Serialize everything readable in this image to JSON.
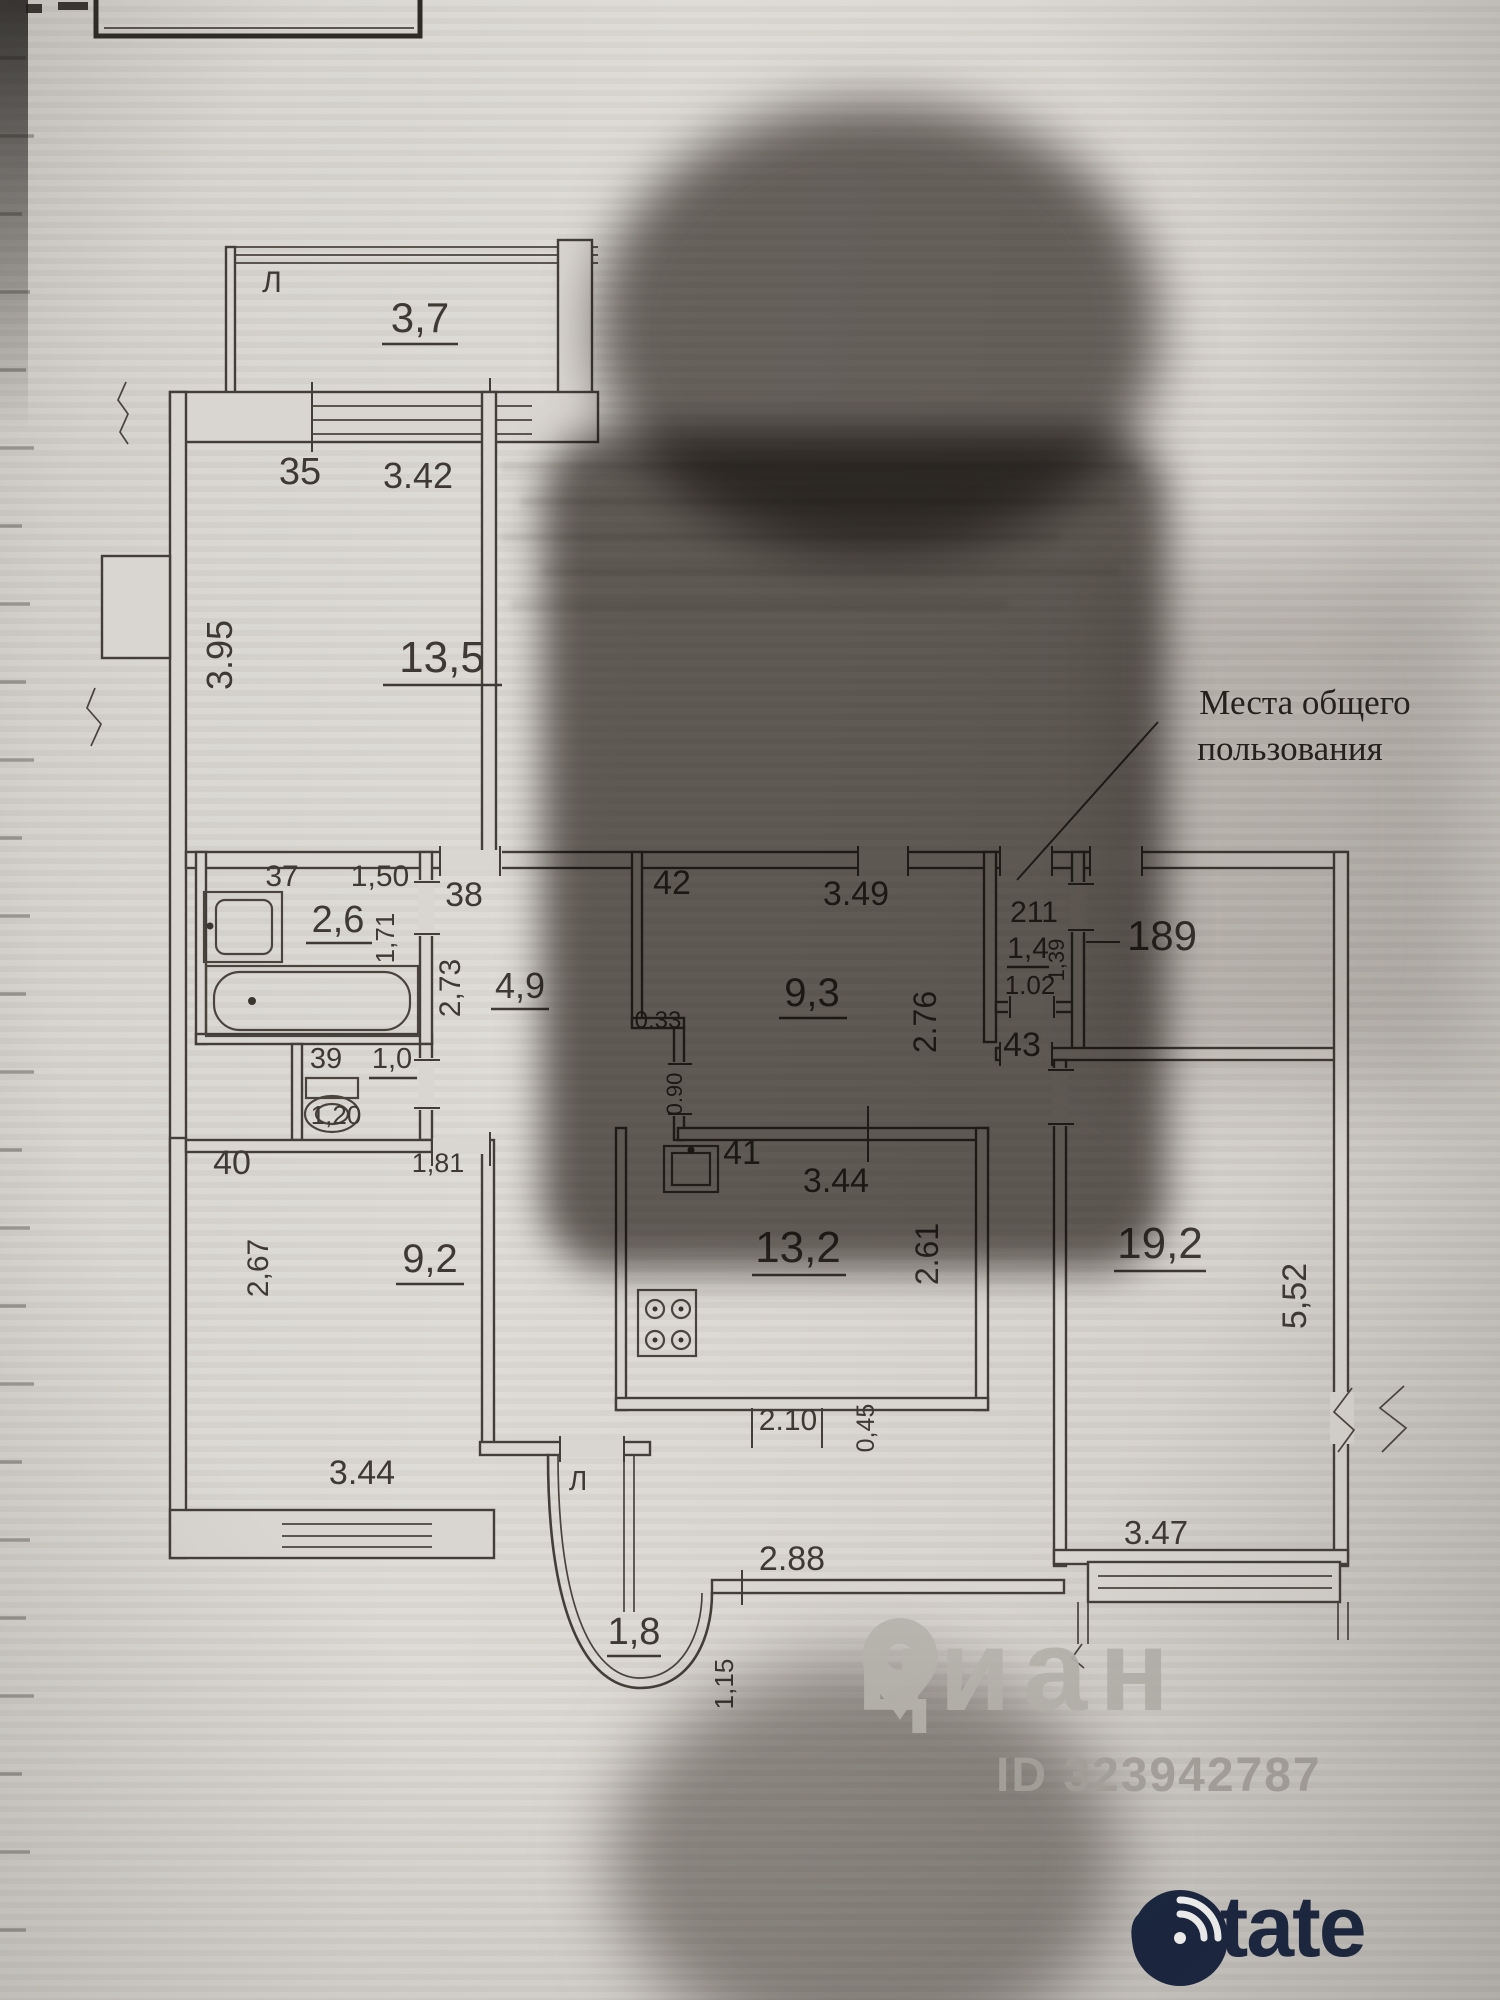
{
  "page": {
    "note": {
      "line1": "Места общего",
      "line2": "пользования"
    },
    "watermark": {
      "brand": "циан",
      "id_label": "ID 323942787"
    },
    "logo": {
      "brand": "Restate",
      "text": "estate"
    }
  },
  "plan": {
    "balcony_top": {
      "letter": "Л",
      "area": "3,7"
    },
    "room35": {
      "number": "35",
      "width": "3.42",
      "height": "3.95",
      "area": "13,5"
    },
    "room37": {
      "number": "37",
      "width": "1,50",
      "height": "1,71",
      "area": "2,6"
    },
    "room38": {
      "number": "38",
      "height": "2,73",
      "area": "4,9",
      "door_width": "1,81"
    },
    "room39": {
      "number": "39",
      "area": "1,0",
      "width": "1,20"
    },
    "room40": {
      "number": "40",
      "height": "2,67",
      "area": "9,2",
      "width": "3.44"
    },
    "room41": {
      "number": "41",
      "width": "3.44",
      "height": "2.61",
      "area": "13,2"
    },
    "room42": {
      "number": "42",
      "width": "3.49",
      "height": "2.76",
      "area": "9,3",
      "wall_step": "0.33",
      "door_width": "0.90"
    },
    "room43": {
      "number": "43"
    },
    "room211": {
      "number": "211",
      "area": "1,4",
      "height": "1,39",
      "width": "1.02"
    },
    "room189": {
      "number": "189"
    },
    "room19": {
      "area": "19,2",
      "height": "5,52",
      "width": "3.47"
    },
    "balcony_bottom": {
      "letter": "Л",
      "area": "1,8"
    },
    "lower_dims": {
      "d1": "2.10",
      "d2": "0,45",
      "d3": "2.88",
      "d4": "1,15"
    }
  }
}
